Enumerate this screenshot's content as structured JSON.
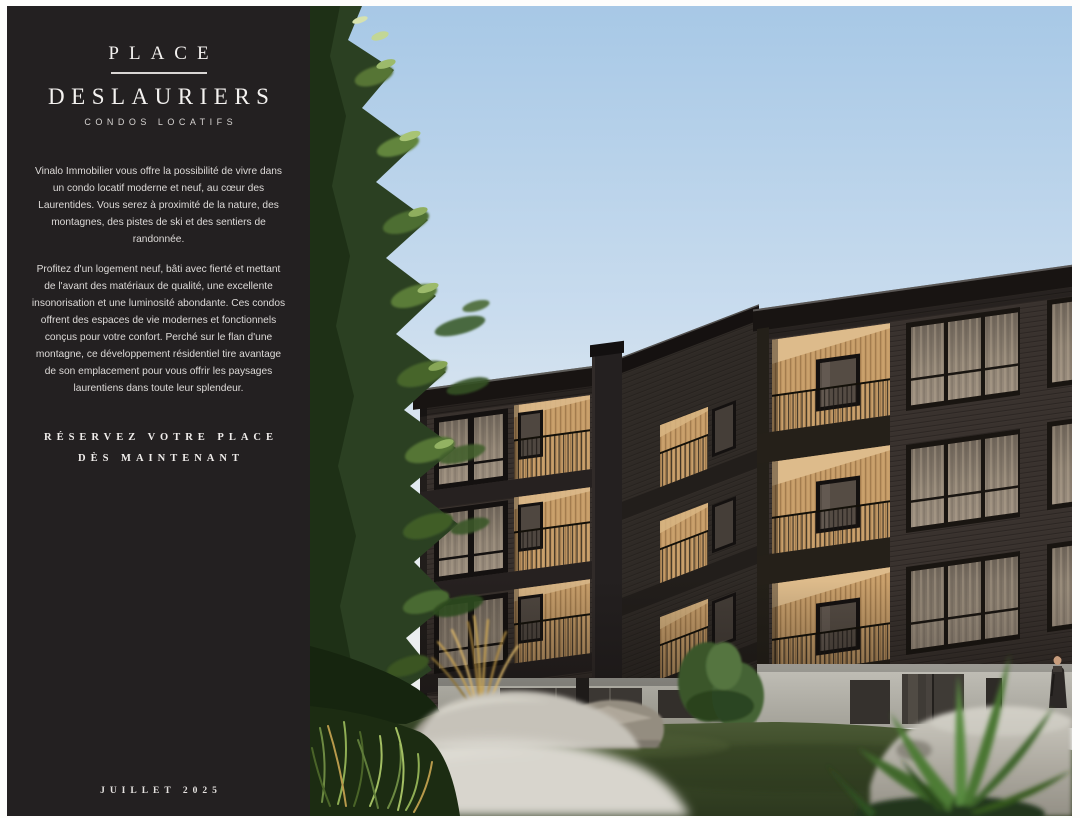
{
  "sidebar": {
    "background_color": "#232021",
    "text_color": "#e8e5e3",
    "title_line1": "PLACE",
    "title_line2": "DESLAURIERS",
    "subtitle": "CONDOS LOCATIFS",
    "paragraphs": [
      "Vinalo Immobilier vous offre la possibilité de vivre dans un condo locatif moderne et neuf, au cœur des Laurentides. Vous serez à proximité de la nature, des montagnes, des pistes de ski et des sentiers de randonnée.",
      "Profitez d'un logement neuf, bâti avec fierté et mettant de l'avant des matériaux de qualité, une excellente insonorisation et une luminosité abondante. Ces condos offrent des espaces de vie modernes et fonctionnels conçus pour votre confort. Perché sur le flan d'une montagne, ce développement résidentiel tire avantage de son emplacement pour vous offrir les paysages laurentiens dans toute leur splendeur."
    ],
    "cta_line1": "RÉSERVEZ VOTRE PLACE",
    "cta_line2": "DÈS MAINTENANT",
    "footer": "JUILLET 2025"
  },
  "photo": {
    "colors": {
      "sky_top": "#a7c8e6",
      "sky_horizon": "#edefee",
      "building_siding": "#38312d",
      "wood_accent": "#c49a66",
      "grass": "#45512e",
      "rock": "#c6c2b9",
      "foliage": "#2b4022"
    }
  }
}
